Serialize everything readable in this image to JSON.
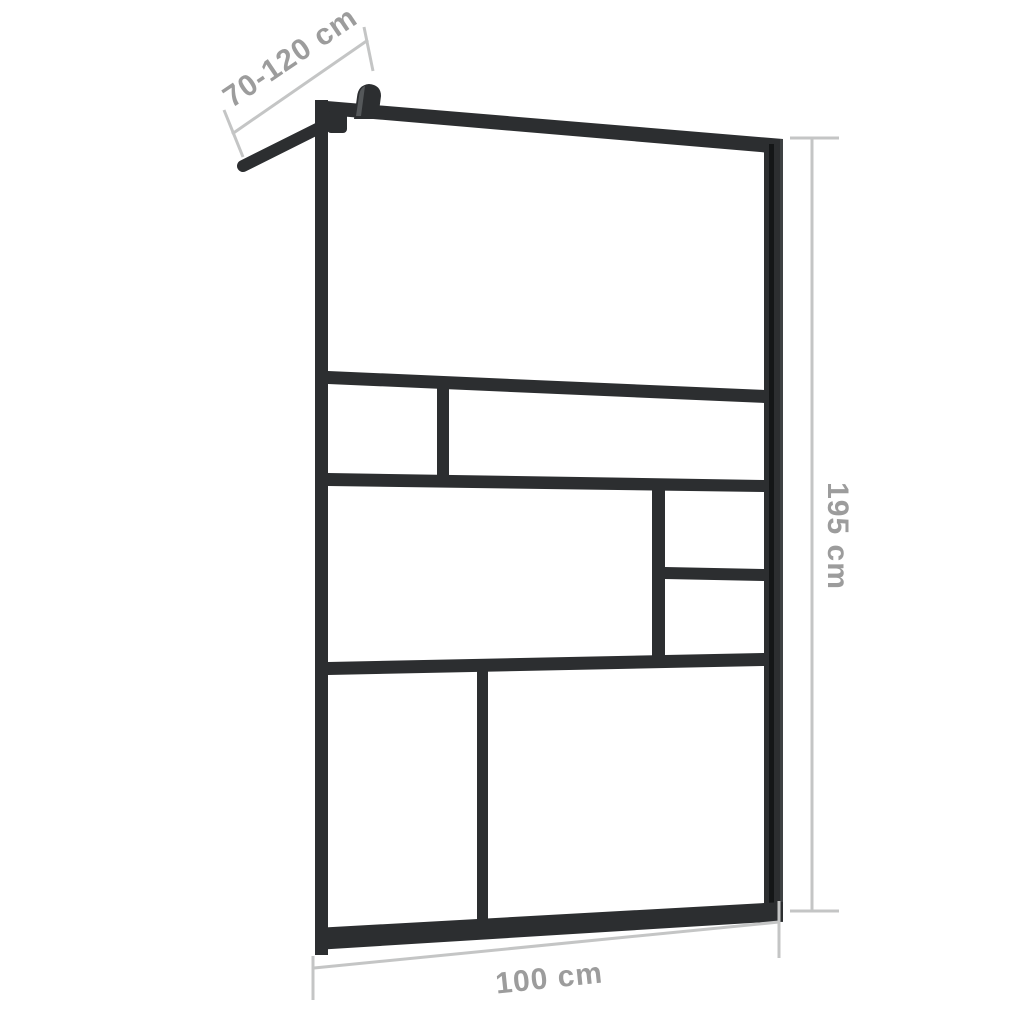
{
  "dimensions": {
    "support_arm": {
      "label": "70-120 cm",
      "value": "70-120",
      "unit": "cm"
    },
    "height": {
      "label": "195 cm",
      "value": "195",
      "unit": "cm"
    },
    "width": {
      "label": "100 cm",
      "value": "100",
      "unit": "cm"
    }
  },
  "colors": {
    "background": "#ffffff",
    "frame": "#2c2e30",
    "frame_seam": "#141617",
    "frame_highlight": "#3e4143",
    "knob_highlight": "#55585a",
    "dimension_line": "#c4c5c5",
    "label_text": "#9c9c9c"
  }
}
